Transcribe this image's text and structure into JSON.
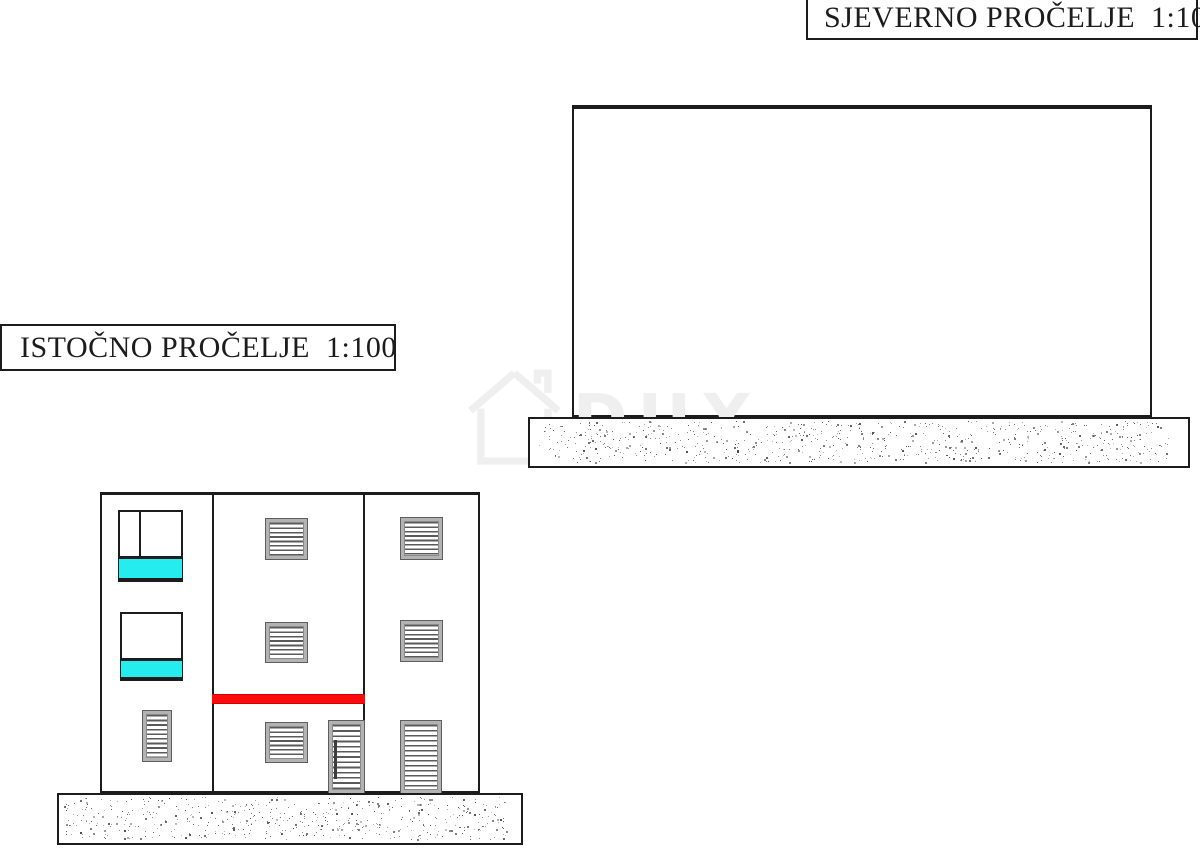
{
  "colors": {
    "background": "#ffffff",
    "line": "#1c1c1c",
    "cyan_fill": "#25edef",
    "red_fill": "#fb0b0b",
    "louver_frame": "#b3b3b3",
    "louver_slat": "#5a5a5a",
    "stipple_dot": "#4a4a4a",
    "watermark": "#efefef"
  },
  "titles": {
    "north": {
      "label": "SJEVERNO PROČELJE  1:100"
    },
    "east": {
      "label": "ISTOČNO PROČELJE  1:100"
    }
  },
  "watermark": {
    "text": "DUX"
  }
}
